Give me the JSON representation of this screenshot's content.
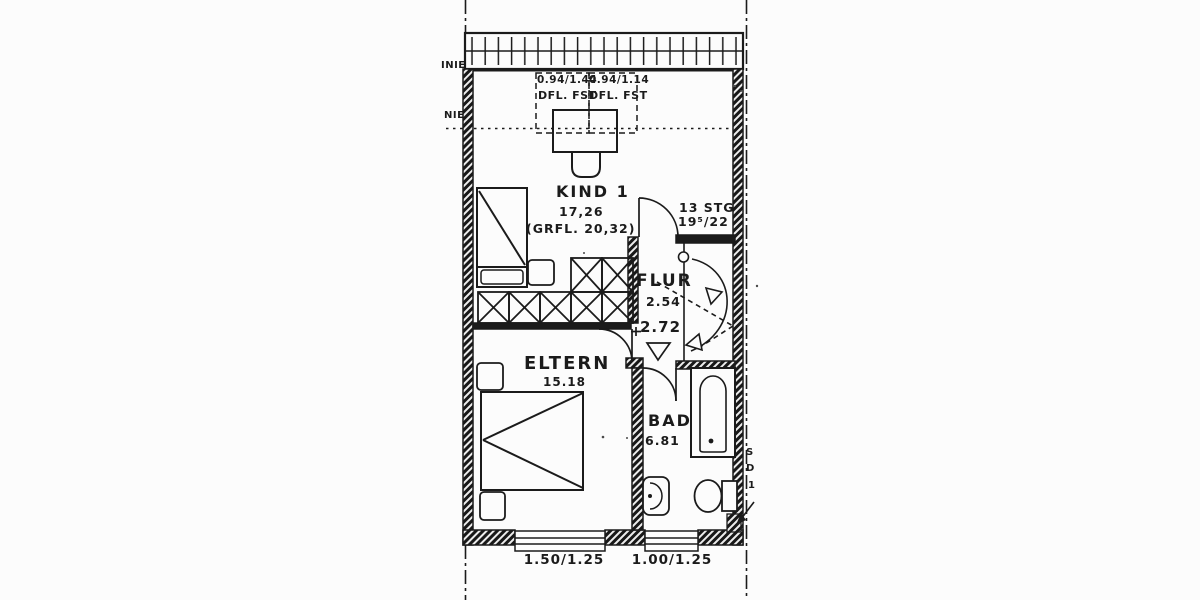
{
  "colors": {
    "ink": "#1b1b1b",
    "paper": "#fcfcfc"
  },
  "rooms": {
    "kind1": {
      "name": "KIND 1",
      "area": "17,26",
      "gross_area": "(GRFL. 20,32)"
    },
    "flur": {
      "name": "FLUR",
      "area": "2.54",
      "clear_height": "2.72"
    },
    "eltern": {
      "name": "ELTERN",
      "area": "15.18"
    },
    "bad": {
      "name": "BAD",
      "area": "6.81"
    }
  },
  "stairs": {
    "count": "13 STG",
    "rise_run": "19⁵/22"
  },
  "roof_windows": [
    {
      "size": "0.94/1.44",
      "type": "DFL. FST"
    },
    {
      "size": "0.94/1.14",
      "type": "DFL. FST"
    }
  ],
  "facade_windows": [
    {
      "size": "1.50/1.25"
    },
    {
      "size": "1.00/1.25"
    }
  ],
  "edge_labels": {
    "upper_left": "INIE",
    "left": "NIE",
    "right_top": "S",
    "right_mid": "D",
    "right_bottom": "1"
  }
}
